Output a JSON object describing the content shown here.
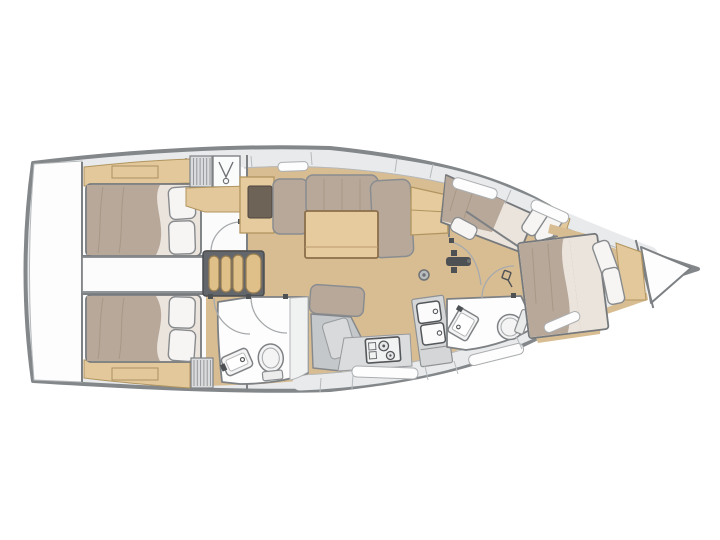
{
  "page": {
    "background": "#ffffff"
  },
  "plan": {
    "title": "Sailing yacht interior layout plan (top view, bow to the right)",
    "view": "top-down",
    "orientation": {
      "bow": "right",
      "stern": "left"
    },
    "counts": {
      "cabins": 4,
      "heads": 2,
      "double_berths": 4
    },
    "rooms": [
      {
        "id": "stern-platform",
        "label": "Stern platform"
      },
      {
        "id": "aft-cabin-port",
        "label": "Aft cabin (port)",
        "furniture": [
          "double berth",
          "two pillows",
          "side shelf"
        ]
      },
      {
        "id": "engine-compartment",
        "label": "Engine compartment"
      },
      {
        "id": "companionway",
        "label": "Companionway steps",
        "steps": 4
      },
      {
        "id": "aft-cabin-starboard",
        "label": "Aft cabin (starboard)",
        "furniture": [
          "double berth",
          "two pillows",
          "side shelf"
        ]
      },
      {
        "id": "aft-head",
        "label": "Aft head",
        "furniture": [
          "toilet",
          "washbasin",
          "shower"
        ]
      },
      {
        "id": "saloon",
        "label": "Saloon",
        "furniture": [
          "L-shaped sofa",
          "dining table",
          "settee",
          "sideboards",
          "mast post"
        ]
      },
      {
        "id": "nav-station",
        "label": "Chart table"
      },
      {
        "id": "galley",
        "label": "Galley",
        "furniture": [
          "two-burner stove",
          "double sink",
          "lockers"
        ]
      },
      {
        "id": "forward-cabin-port",
        "label": "Forward cabin (port)",
        "furniture": [
          "angled double berth",
          "two pillows"
        ]
      },
      {
        "id": "forward-head",
        "label": "Forward head",
        "furniture": [
          "toilet",
          "washbasin"
        ]
      },
      {
        "id": "bow-cabin",
        "label": "Bow cabin",
        "furniture": [
          "angled double berth",
          "two pillows",
          "headboard shelf"
        ]
      },
      {
        "id": "forepeak",
        "label": "Forepeak locker"
      }
    ]
  },
  "palette": {
    "bg": "#ffffff",
    "hullFill": "#e8eaec",
    "hullStroke": "#83878a",
    "sheerLine": "#b6b9bb",
    "interior": "#fbfbfc",
    "roomWhite": "#fdfdfd",
    "wallStroke": "#7e8184",
    "wood": "#d8bd93",
    "woodEdge": "#b1955f",
    "woodFurniture": "#e6cb9e",
    "woodShelf": "#e3c89b",
    "upholstery": "#b7a89a",
    "upholsteryEdge": "#8a8d90",
    "foldLine": "#a08f7a",
    "sheet": "#ebe4dc",
    "mattressEdge": "#76797c",
    "pillow": "#f6f5f3",
    "pillowEdge": "#888b8e",
    "darkInset": "#6e6357",
    "stepsFrame": "#63666a",
    "stepsTread": "#e0c089",
    "stepsTreadEdge": "#977c50",
    "consoleGrey": "#c5c8ca",
    "consoleLight": "#d8dadb",
    "counterGrey": "#dadcdd",
    "fixtureStroke": "#7f8285",
    "fixtureFill": "#f4f4f4",
    "windowWhite": "#fdfdfd",
    "windowEdge": "#abaeb0",
    "divider": "#b7babc",
    "doorArc": "#a7aaac",
    "hardware": "#4e5154"
  }
}
